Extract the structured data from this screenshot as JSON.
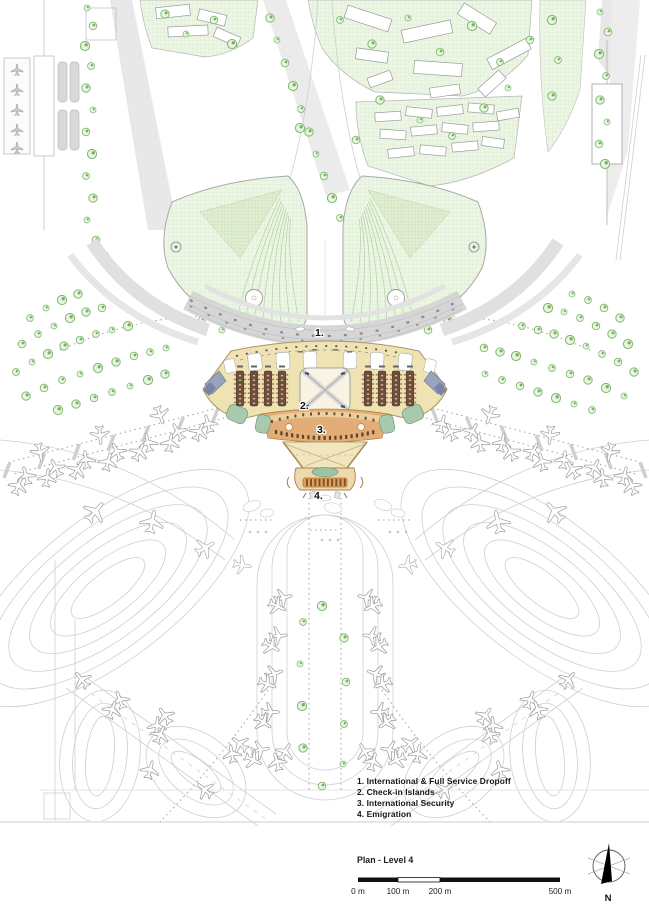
{
  "caption": "Plan - Level 4",
  "plan_labels": {
    "l1": "1.",
    "l2": "2.",
    "l3": "3.",
    "l4": "4."
  },
  "legend": {
    "items": [
      "1. International & Full Service Dropoff",
      "2. Check-in Islands",
      "3. International Security",
      "4. Emigration"
    ]
  },
  "scale_bar": {
    "labels": [
      "0 m",
      "100 m",
      "200 m",
      "500 m"
    ]
  },
  "compass": {
    "north": "N"
  },
  "colors": {
    "terminal_hall": "#efe3b3",
    "security_band": "#e2ad76",
    "emigration_strip": "#dca05f",
    "checkin_island": "#6e4f3e",
    "teal_zone": "#a8c9ae",
    "transit_zone": "#9aa3bd",
    "lawn": "#edf5e6",
    "tree": "#7fba6e",
    "road": "#d6d6d6"
  }
}
